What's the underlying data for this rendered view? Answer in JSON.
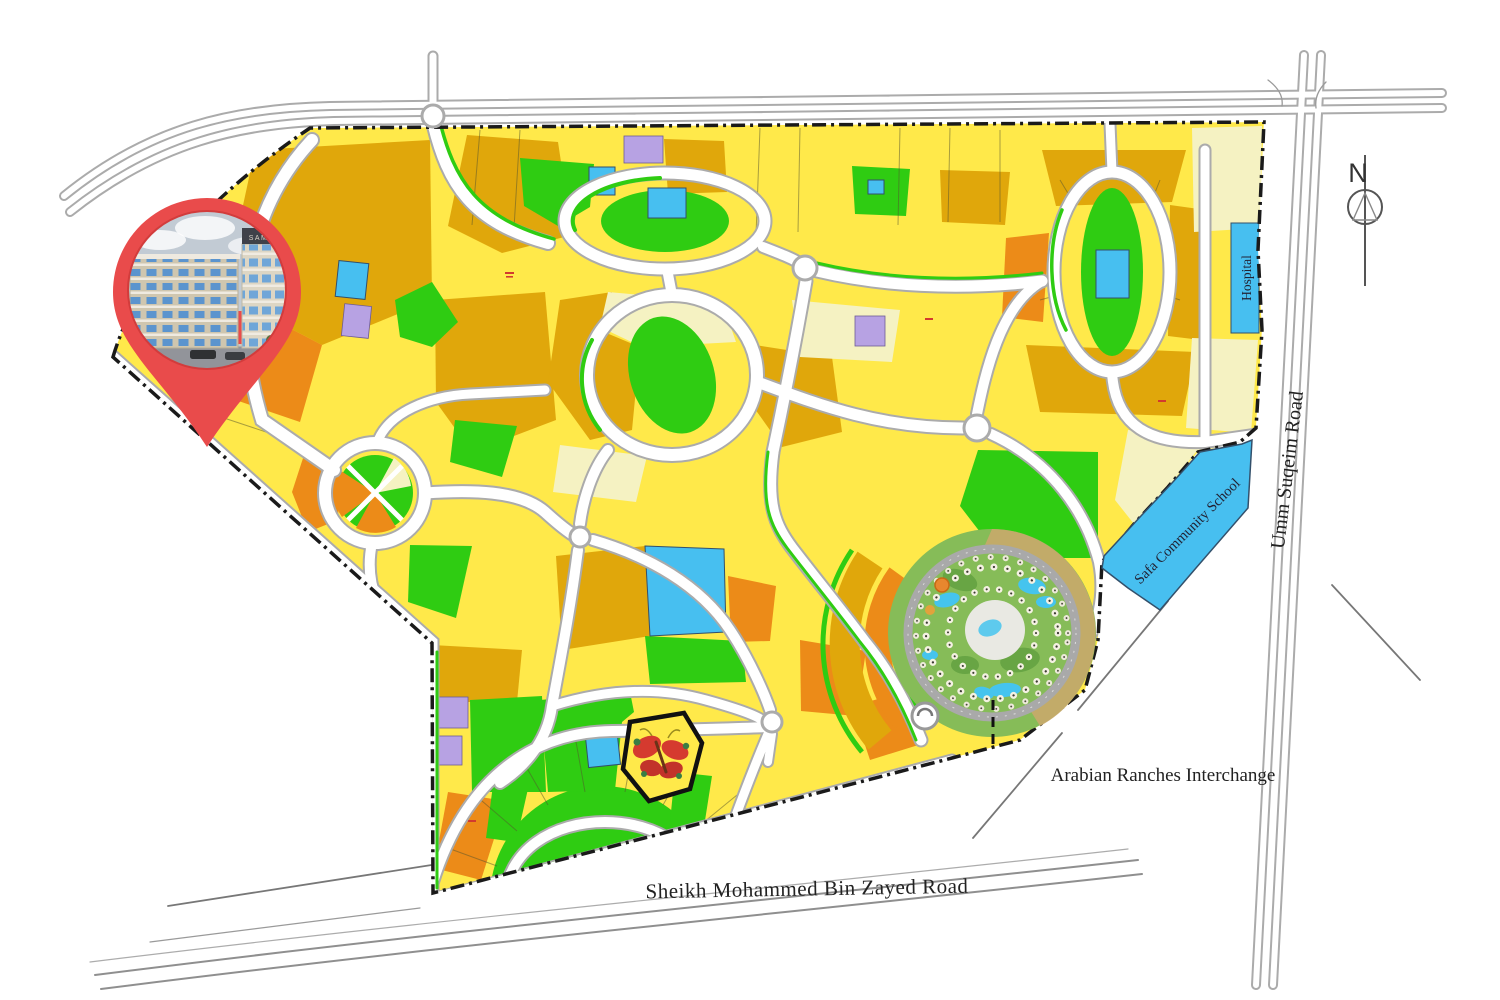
{
  "map": {
    "labels": {
      "north_indicator": "N",
      "hospital": "Hospital",
      "school": "Safa Community School",
      "umm_suqeim_road": "Umm Suqeim Road",
      "sheikh_mohammed_bin_zayed_road": "Sheikh Mohammed Bin Zayed Road",
      "arabian_ranches_interchange": "Arabian Ranches Interchange"
    },
    "pin": {
      "building_sign": "SAMANA"
    },
    "colors": {
      "residential_yellow": "#FFE94A",
      "low_rise_ochre": "#E0A70B",
      "mid_rise_orange": "#EC8B18",
      "park_green": "#2FCC12",
      "community_cream": "#F5F2C2",
      "facility_blue": "#47BFF0",
      "mosque_purple": "#B7A2E3",
      "road_white": "#FFFFFF",
      "road_casing_gray": "#ABABAB",
      "boundary_black": "#1A1A1A",
      "pin_red": "#E94B4B",
      "town_center_green": "#86BC58",
      "water_blue": "#45C4EE"
    }
  }
}
